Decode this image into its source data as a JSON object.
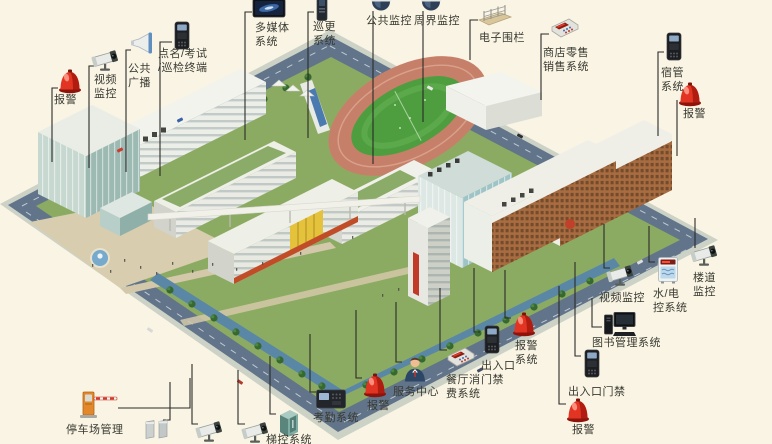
{
  "colors": {
    "background": "#f9f4e3",
    "leader_line": "#2b2b28",
    "label_text": "#3a3a32",
    "alarm_red": "#e23423",
    "lawn_green": "#8cab62",
    "road_blue_gray": "#61748a",
    "track_terracotta": "#c6806a"
  },
  "callouts": [
    {
      "id": "alarm-top-left",
      "icon": "alarm-beacon",
      "label": "报警",
      "x": 70,
      "y": 81,
      "lx": 54,
      "ly": 93,
      "leader": "M58,88 H52 V162"
    },
    {
      "id": "video-monitor-top-left",
      "icon": "bullet-camera",
      "label": "视频\n监控",
      "x": 107,
      "y": 61,
      "lx": 94,
      "ly": 73,
      "leader": "M95,66 H89 V168"
    },
    {
      "id": "public-broadcast",
      "icon": "horn-speaker",
      "label": "公共\n广播",
      "x": 142,
      "y": 44,
      "lx": 128,
      "ly": 62,
      "leader": "M131,50 H126 V172"
    },
    {
      "id": "rollcall-exam-patrol-terminal",
      "icon": "terminal",
      "label": "点名/考试\n/巡检终端",
      "x": 182,
      "y": 36,
      "lx": 158,
      "ly": 47,
      "leader": "M172,42 H160 V176"
    },
    {
      "id": "multimedia-system",
      "icon": "flat-screen",
      "label": "多媒体\n系统",
      "x": 269,
      "y": 9,
      "lx": 255,
      "ly": 21,
      "leader": "M252,12 H245 V140"
    },
    {
      "id": "patrol-system",
      "icon": "patrol-device",
      "label": "巡更\n系统",
      "x": 322,
      "y": 8,
      "lx": 313,
      "ly": 20,
      "leader": "M314,12 H308 V138"
    },
    {
      "id": "public-surveillance",
      "icon": "dome-camera",
      "label": "公共监控",
      "x": 381,
      "y": 5,
      "lx": 366,
      "ly": 14,
      "leader": "M373,11 V164"
    },
    {
      "id": "perimeter-surveillance",
      "icon": "dome-camera",
      "label": "周界监控",
      "x": 431,
      "y": 5,
      "lx": 414,
      "ly": 14,
      "leader": "M423,11 V122"
    },
    {
      "id": "electronic-fence",
      "icon": "fence",
      "label": "电子围栏",
      "x": 495,
      "y": 15,
      "lx": 479,
      "ly": 31,
      "leader": "M478,20 H470 V60"
    },
    {
      "id": "retail-pos-system",
      "icon": "pos-machine",
      "label": "商店零售\n销售系统",
      "x": 565,
      "y": 28,
      "lx": 543,
      "ly": 46,
      "leader": "M549,34 H541 V100"
    },
    {
      "id": "dorm-management-system",
      "icon": "terminal",
      "label": "宿管\n系统",
      "x": 674,
      "y": 47,
      "lx": 661,
      "ly": 66,
      "leader": "M664,52 H658 V136"
    },
    {
      "id": "alarm-top-right",
      "icon": "alarm-beacon",
      "label": "报警",
      "x": 690,
      "y": 94,
      "lx": 683,
      "ly": 107,
      "leader": "M677,100 V156"
    },
    {
      "id": "corridor-monitor",
      "icon": "bullet-camera",
      "label": "楼道\n监控",
      "x": 706,
      "y": 256,
      "lx": 693,
      "ly": 271,
      "leader": "M695,248 V218"
    },
    {
      "id": "water-electric-control",
      "icon": "water-elec-box",
      "label": "水/电\n控系统",
      "x": 668,
      "y": 270,
      "lx": 653,
      "ly": 287,
      "leader": "M655,262 H649 V226"
    },
    {
      "id": "video-monitor-right",
      "icon": "bullet-camera",
      "label": "视频监控",
      "x": 622,
      "y": 276,
      "lx": 599,
      "ly": 291,
      "leader": "M610,268 H604 V224"
    },
    {
      "id": "library-management-system",
      "icon": "computer",
      "label": "图书管理系统",
      "x": 620,
      "y": 325,
      "lx": 592,
      "ly": 336,
      "leader": "M602,327 H592 V298"
    },
    {
      "id": "entrance-access-right",
      "icon": "terminal",
      "label": "出入口门禁",
      "x": 592,
      "y": 364,
      "lx": 568,
      "ly": 385,
      "leader": "M581,356 H575 V262"
    },
    {
      "id": "alarm-bottom-right",
      "icon": "alarm-beacon",
      "label": "报警",
      "x": 578,
      "y": 410,
      "lx": 572,
      "ly": 423,
      "leader": "M566,404 H559 V286"
    },
    {
      "id": "alarm-system",
      "icon": "alarm-beacon",
      "label": "报警\n系统",
      "x": 524,
      "y": 324,
      "lx": 515,
      "ly": 339,
      "leader": "M511,318 H505 V270"
    },
    {
      "id": "entrance-access-center",
      "icon": "terminal",
      "label": "出入口\n门禁",
      "x": 492,
      "y": 340,
      "lx": 481,
      "ly": 359,
      "leader": "M480,332 H474 V268"
    },
    {
      "id": "canteen-payment-system",
      "icon": "pos-machine",
      "label": "餐厅消\n费系统",
      "x": 461,
      "y": 357,
      "lx": 446,
      "ly": 373,
      "leader": "M447,350 H440 V288"
    },
    {
      "id": "service-center",
      "icon": "person",
      "label": "服务中心",
      "x": 415,
      "y": 369,
      "lx": 393,
      "ly": 385,
      "leader": "M402,362 H396 V302"
    },
    {
      "id": "alarm-bottom",
      "icon": "alarm-beacon",
      "label": "报警",
      "x": 375,
      "y": 385,
      "lx": 367,
      "ly": 399,
      "leader": "M362,378 H356 V310"
    },
    {
      "id": "attendance-system",
      "icon": "attendance-terminal",
      "label": "考勤系统",
      "x": 331,
      "y": 399,
      "lx": 313,
      "ly": 411,
      "leader": "M316,392 H310 V334"
    },
    {
      "id": "elevator-control-system",
      "icon": "elevator",
      "label": "梯控系统",
      "x": 289,
      "y": 423,
      "lx": 266,
      "ly": 433,
      "leader": "M276,414 H270 V356"
    },
    {
      "id": "camera-bottom-1",
      "icon": "bullet-camera",
      "x": 257,
      "y": 433,
      "leader": "M245,424 H238 V370"
    },
    {
      "id": "camera-bottom-2",
      "icon": "bullet-camera",
      "x": 211,
      "y": 432,
      "leader": "M198,424 H192 V364"
    },
    {
      "id": "pedestrian-gates",
      "icon": "swing-gates",
      "x": 157,
      "y": 429,
      "leader": "M163,420 H170 V382"
    },
    {
      "id": "parking-management",
      "icon": "barrier-gate",
      "label": "停车场管理",
      "x": 97,
      "y": 404,
      "lx": 66,
      "ly": 423,
      "leader": "M118,408 H190 V378"
    }
  ]
}
